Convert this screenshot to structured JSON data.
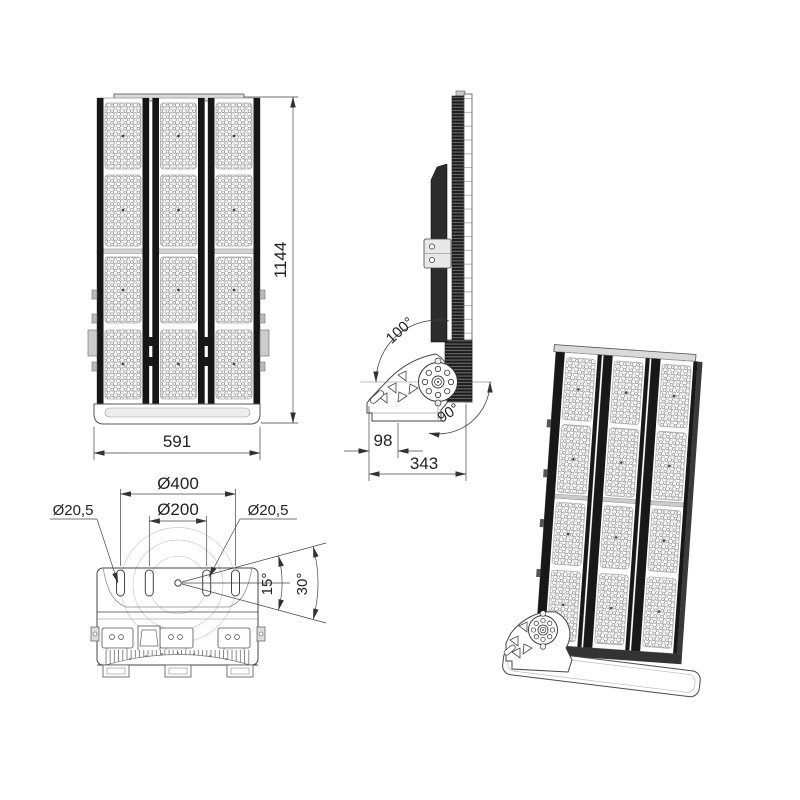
{
  "title": "LED floodlight multi-view technical drawing",
  "views": {
    "front": {
      "height_dim": "1144",
      "width_dim": "591"
    },
    "side": {
      "rotation_up_dim": "100°",
      "rotation_down_dim": "90°",
      "bracket_base_dim": "98",
      "depth_dim": "343"
    },
    "bottom": {
      "outer_bolt_circle_dim": "Ø400",
      "inner_bolt_circle_dim": "Ø200",
      "slot_dia_left_dim": "Ø20,5",
      "slot_dia_right_dim": "Ø20,5",
      "swivel_angle_half_dim": "15°",
      "swivel_angle_full_dim": "30°"
    }
  },
  "colors": {
    "line": "#3c3c3c",
    "dark_rail": "#161616",
    "dimension": "#333333",
    "light_fill": "#d9d9d9",
    "background": "#ffffff"
  }
}
